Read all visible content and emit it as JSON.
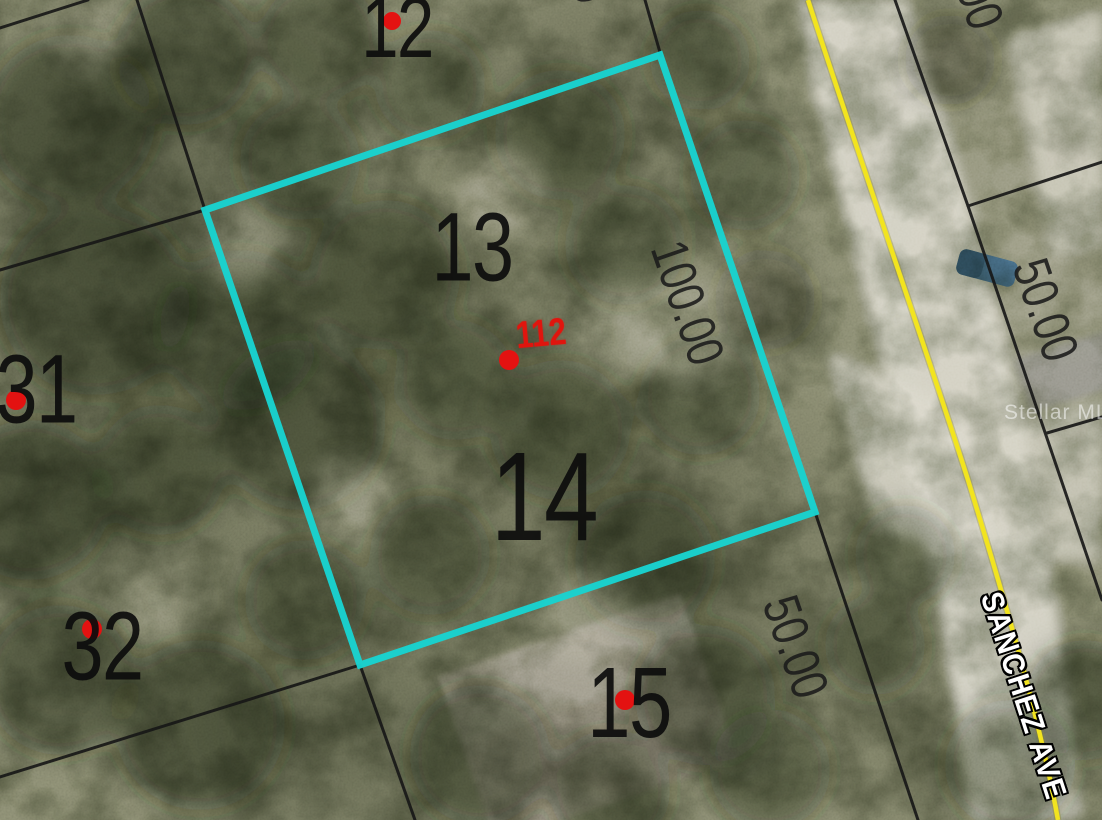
{
  "map": {
    "type": "aerial-parcel-map",
    "watermark": "Stellar MLS",
    "street": {
      "name": "SANCHEZ AVE",
      "centerline_color": "#f2e41f"
    },
    "subject_property": {
      "marker_label": "112",
      "marker_color": "#e0150e",
      "outline_color": "#19d3d0",
      "lots_included": "13, 14"
    },
    "lots": [
      {
        "number": "12"
      },
      {
        "number": "13"
      },
      {
        "number": "14"
      },
      {
        "number": "15"
      },
      {
        "number": "31"
      },
      {
        "number": "32"
      }
    ],
    "dimensions": [
      {
        "label": "100.00"
      },
      {
        "label": "50.00"
      },
      {
        "label": "50.00"
      },
      {
        "label": "50.00"
      },
      {
        "label": "50.00"
      }
    ],
    "colors": {
      "parcel_line": "#161616",
      "lot_number_text": "#0c0c0c",
      "dimension_text": "#1b1b1b",
      "street_label_text": "#ffffff",
      "highlight": "#19d3d0",
      "centerline_yellow": "#f2e41f",
      "red_dot": "#e31211"
    }
  }
}
